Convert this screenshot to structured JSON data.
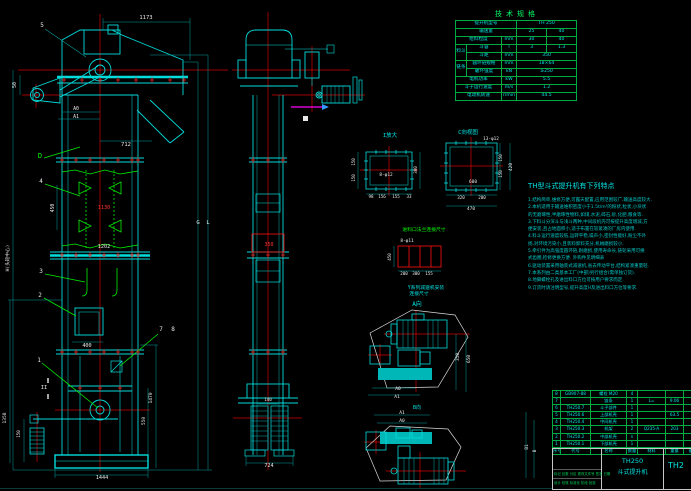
{
  "colors": {
    "cyan": "#00e5e5",
    "red": "#ff3333",
    "green": "#00ff00",
    "white": "#e8e8e8",
    "magenta": "#ff00ff",
    "grid_green": "#00aa44",
    "blue": "#3399ff"
  },
  "spec": {
    "title": "技术规格",
    "rows": [
      [
        {
          "t": "提升机型号",
          "cs": 3
        },
        {
          "t": "TH 250",
          "cs": 2
        }
      ],
      [
        {
          "t": "输送量",
          "cs": 3
        },
        {
          "t": "25"
        },
        {
          "t": "40"
        }
      ],
      [
        {
          "t": "给料粒度",
          "cs": 2
        },
        {
          "t": "mm"
        },
        {
          "t": "30"
        },
        {
          "t": "40"
        }
      ],
      [
        {
          "t": "料斗",
          "rs": 2
        },
        {
          "t": "斗容"
        },
        {
          "t": "l"
        },
        {
          "t": "3"
        },
        {
          "t": "1.3"
        }
      ],
      [
        {
          "t": "斗距"
        },
        {
          "t": "mm"
        },
        {
          "t": "350",
          "cs": 2
        }
      ],
      [
        {
          "t": "链条",
          "rs": 2
        },
        {
          "t": "圆环链规格"
        },
        {
          "t": "mm"
        },
        {
          "t": "18×64",
          "cs": 2
        }
      ],
      [
        {
          "t": "破坏强度"
        },
        {
          "t": "kN"
        },
        {
          "t": "≥250",
          "cs": 2
        }
      ],
      [
        {
          "t": "电机功率",
          "cs": 2
        },
        {
          "t": "kW"
        },
        {
          "t": "5.5",
          "cs": 2
        }
      ],
      [
        {
          "t": "斗子运行速度",
          "cs": 2
        },
        {
          "t": "m/s"
        },
        {
          "t": "1.2",
          "cs": 2
        }
      ],
      [
        {
          "t": "电动机转速",
          "cs": 2
        },
        {
          "t": "r/min"
        },
        {
          "t": "44.5",
          "cs": 2
        }
      ]
    ]
  },
  "notes": {
    "title": "TH型斗式提升机有下列特点",
    "lines": [
      "1.结构简单,维修方便,可露天配置,应用范围较广,输送高度较大.",
      "2.本机适用于输送堆积密度小于1.5t/m³的粉状,粒状,小块状",
      "  的无磨琢性,半磨琢性物料,如煤,水泥,碎石,砂,化肥,粮食等.",
      "3.下料斗分深斗与浅斗两种,中间段机壳可按提升高度增减,方",
      "  便安装,且占地面积小,适于布置在较紧凑的厂房内使用.",
      "4.料斗运行速度较低,运转平稳,噪声小,密封性能好,粉尘不外",
      "  扬,对环境污染小,且装料卸料充分,机械磨损较小.",
      "5.牵引件为高强度圆环链,耐磨损,使用寿命长,链轮采用可换",
      "  式齿圈,检修更换方便.              外购件见明细表",
      "6.驱动装置采用轴装式减速机,省去传动平台,结构紧凑重量轻.",
      "7.本系列由二类基本工厂(中部)另行组合(需单独订货).",
      "8.地脚螺栓孔及进出料口方位可按用户要求而定.",
      "9.订货时请注明型号,提升高度H及进出料口方位等要求."
    ]
  },
  "bom": {
    "headers": [
      "序号",
      "代号",
      "名称",
      "数量",
      "材料",
      "重量",
      "备注"
    ],
    "rows": [
      [
        "8",
        "GB907-88",
        "螺栓 M20",
        "4",
        "",
        "",
        ""
      ],
      [
        "7",
        "",
        "链条",
        "1",
        "L=",
        "9.06",
        ""
      ],
      [
        "6",
        "TH250.7",
        "斗子部件",
        "1",
        "",
        "",
        ""
      ],
      [
        "5",
        "TH250.6",
        "上部机壳",
        "1",
        "",
        "63.5",
        ""
      ],
      [
        "4",
        "TH250.4",
        "中间机壳",
        "1",
        "",
        "",
        ""
      ],
      [
        "3",
        "TH250.3",
        "机架",
        "2",
        "Q235-A",
        "203",
        ""
      ],
      [
        "2",
        "TH250.2",
        "中部机壳",
        "n",
        "",
        "",
        ""
      ],
      [
        "1",
        "TH250.1",
        "下部机壳",
        "1",
        "",
        "",
        ""
      ]
    ]
  },
  "title_block": {
    "model": "TH250",
    "name": "斗式提升机",
    "drawing_no": "TH2",
    "rev_row": "标记 处数 分区 更改文件号 签名 日期",
    "sig_row": "设计  校核  标准化  阶段  批准"
  },
  "annotations": [
    {
      "t": "5",
      "x": 42,
      "y": 27,
      "c": "w",
      "s": 6
    },
    {
      "t": "1173",
      "x": 146,
      "y": 19,
      "c": "w",
      "s": 5.5
    },
    {
      "t": "50",
      "x": 16,
      "y": 85,
      "c": "w",
      "s": 5,
      "r": -90
    },
    {
      "t": "A0",
      "x": 76,
      "y": 110,
      "c": "w",
      "s": 4.8
    },
    {
      "t": "A1",
      "x": 76,
      "y": 118,
      "c": "w",
      "s": 4.8
    },
    {
      "t": "712",
      "x": 126,
      "y": 146,
      "c": "w",
      "s": 5.5
    },
    {
      "t": "D",
      "x": 40,
      "y": 158,
      "c": "g",
      "s": 7
    },
    {
      "t": "4",
      "x": 41,
      "y": 183,
      "c": "w",
      "s": 6
    },
    {
      "t": "450",
      "x": 54,
      "y": 208,
      "c": "w",
      "s": 4.8,
      "r": -90
    },
    {
      "t": "1130",
      "x": 104,
      "y": 209,
      "c": "r",
      "s": 5.2
    },
    {
      "t": "1202",
      "x": 104,
      "y": 248,
      "c": "w",
      "s": 5.2
    },
    {
      "t": "3",
      "x": 41,
      "y": 273,
      "c": "w",
      "s": 6
    },
    {
      "t": "2",
      "x": 40,
      "y": 297,
      "c": "w",
      "s": 6
    },
    {
      "t": "400",
      "x": 87,
      "y": 347,
      "c": "w",
      "s": 5.2
    },
    {
      "t": "1",
      "x": 39,
      "y": 362,
      "c": "w",
      "s": 6
    },
    {
      "t": "7",
      "x": 161,
      "y": 331,
      "c": "w",
      "s": 6
    },
    {
      "t": "8",
      "x": 173,
      "y": 331,
      "c": "w",
      "s": 6
    },
    {
      "t": "II",
      "x": 44,
      "y": 389,
      "c": "w",
      "s": 5.5
    },
    {
      "t": "H(头轮中心)",
      "x": 9,
      "y": 258,
      "c": "w",
      "s": 4.6,
      "r": -90
    },
    {
      "t": "1358",
      "x": 6,
      "y": 418,
      "c": "w",
      "s": 4.6,
      "r": -90
    },
    {
      "t": "150",
      "x": 20,
      "y": 434,
      "c": "w",
      "s": 4.2,
      "r": -90
    },
    {
      "t": "1470",
      "x": 152,
      "y": 398,
      "c": "w",
      "s": 4.6,
      "r": -90
    },
    {
      "t": "550",
      "x": 145,
      "y": 421,
      "c": "w",
      "s": 4.6,
      "r": -90
    },
    {
      "t": "1444",
      "x": 102,
      "y": 479,
      "c": "w",
      "s": 5.2
    },
    {
      "t": "G",
      "x": 198,
      "y": 224,
      "c": "w",
      "s": 5.5
    },
    {
      "t": "L",
      "x": 208,
      "y": 224,
      "c": "w",
      "s": 5.5
    },
    {
      "t": "350",
      "x": 269,
      "y": 246,
      "c": "r",
      "s": 5
    },
    {
      "t": "140",
      "x": 268,
      "y": 401,
      "c": "w",
      "s": 4.2
    },
    {
      "t": "724",
      "x": 269,
      "y": 467,
      "c": "w",
      "s": 5.2
    },
    {
      "t": "I放大",
      "x": 390,
      "y": 137,
      "c": "c",
      "s": 5.5
    },
    {
      "t": "8-φ12",
      "x": 386,
      "y": 176,
      "c": "w",
      "s": 4.4
    },
    {
      "t": "150",
      "x": 355,
      "y": 162,
      "c": "w",
      "s": 4.2,
      "r": -90
    },
    {
      "t": "150",
      "x": 355,
      "y": 178,
      "c": "w",
      "s": 4.2,
      "r": -90
    },
    {
      "t": "300",
      "x": 417,
      "y": 170,
      "c": "w",
      "s": 4.2,
      "r": -90
    },
    {
      "t": "98",
      "x": 371,
      "y": 198,
      "c": "w",
      "s": 4.2
    },
    {
      "t": "156",
      "x": 382,
      "y": 198,
      "c": "w",
      "s": 4.2
    },
    {
      "t": "155",
      "x": 396,
      "y": 198,
      "c": "w",
      "s": 4.2
    },
    {
      "t": "33",
      "x": 409,
      "y": 198,
      "c": "w",
      "s": 4.2
    },
    {
      "t": "C向视图",
      "x": 468,
      "y": 134,
      "c": "c",
      "s": 5.5
    },
    {
      "t": "13-φ12",
      "x": 491,
      "y": 140,
      "c": "w",
      "s": 4.4
    },
    {
      "t": "600",
      "x": 473,
      "y": 183,
      "c": "w",
      "s": 4.4
    },
    {
      "t": "320",
      "x": 461,
      "y": 199,
      "c": "w",
      "s": 4.2
    },
    {
      "t": "200",
      "x": 482,
      "y": 199,
      "c": "w",
      "s": 4.2
    },
    {
      "t": "470",
      "x": 471,
      "y": 210,
      "c": "w",
      "s": 4.4
    },
    {
      "t": "150",
      "x": 502,
      "y": 158,
      "c": "w",
      "s": 4.2,
      "r": -90
    },
    {
      "t": "150",
      "x": 502,
      "y": 174,
      "c": "w",
      "s": 4.2,
      "r": -90
    },
    {
      "t": "420",
      "x": 512,
      "y": 167,
      "c": "w",
      "s": 4.4,
      "r": -90
    },
    {
      "t": "进料口法兰连接尺寸",
      "x": 424,
      "y": 231,
      "c": "g",
      "s": 4.8
    },
    {
      "t": "8-φ11",
      "x": 407,
      "y": 242,
      "c": "w",
      "s": 4.4
    },
    {
      "t": "450",
      "x": 391,
      "y": 257,
      "c": "w",
      "s": 4.2,
      "r": -90
    },
    {
      "t": "200",
      "x": 404,
      "y": 275,
      "c": "w",
      "s": 4.2
    },
    {
      "t": "300",
      "x": 416,
      "y": 275,
      "c": "w",
      "s": 4.2
    },
    {
      "t": "155",
      "x": 429,
      "y": 275,
      "c": "w",
      "s": 4.2
    },
    {
      "t": "Y系列减速机安装",
      "x": 426,
      "y": 289,
      "c": "c",
      "s": 4.8
    },
    {
      "t": "连接尺寸",
      "x": 419,
      "y": 295,
      "c": "c",
      "s": 4.8
    },
    {
      "t": "A向",
      "x": 417,
      "y": 306,
      "c": "c",
      "s": 6
    },
    {
      "t": "350",
      "x": 459,
      "y": 357,
      "c": "w",
      "s": 4.4,
      "r": -90
    },
    {
      "t": "650",
      "x": 470,
      "y": 359,
      "c": "w",
      "s": 4.4,
      "r": -90
    },
    {
      "t": "A0",
      "x": 398,
      "y": 390,
      "c": "w",
      "s": 4.6
    },
    {
      "t": "A1",
      "x": 397,
      "y": 398,
      "c": "w",
      "s": 4.6
    },
    {
      "t": "B向",
      "x": 417,
      "y": 409,
      "c": "c",
      "s": 5
    },
    {
      "t": "A1",
      "x": 402,
      "y": 414,
      "c": "w",
      "s": 4.6
    },
    {
      "t": "A0",
      "x": 402,
      "y": 422,
      "c": "w",
      "s": 4.6
    },
    {
      "t": "B1",
      "x": 528,
      "y": 447,
      "c": "w",
      "s": 4.4,
      "r": -90
    },
    {
      "t": "B",
      "x": 536,
      "y": 451,
      "c": "w",
      "s": 4.4,
      "r": -90
    }
  ]
}
